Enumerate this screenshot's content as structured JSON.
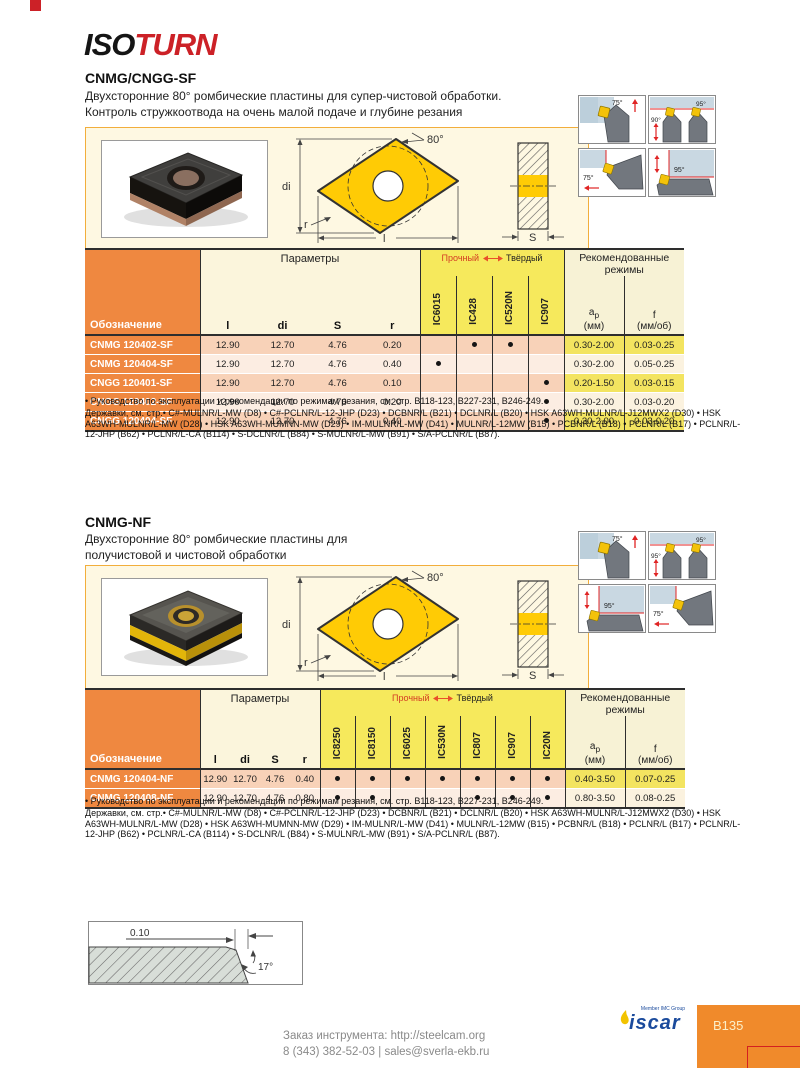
{
  "logo": {
    "part1": "ISO",
    "part2": "TURN"
  },
  "colors": {
    "accent_orange": "#EF8840",
    "grade_yellow": "#F6E95C",
    "row_pink": "#F8D2B8",
    "highlight_yellow": "#F3E460",
    "brand_red": "#CC2127",
    "iscar_blue": "#1A4A9C",
    "panel_cream": "#FEF8E2"
  },
  "sections": [
    {
      "title": "CNMG/CNGG-SF",
      "desc": [
        "Двухсторонние 80° ромбические пластины для супер-чистовой обработки.",
        "Контроль стружкоотвода на очень малой подаче и глубине резания"
      ],
      "tool_icons": [
        {
          "type": 0,
          "angles": [
            "75°"
          ]
        },
        {
          "type": 1,
          "angles": [
            "95°",
            "90°"
          ]
        },
        {
          "type": 2,
          "angles": [
            "75°"
          ]
        },
        {
          "type": 3,
          "angles": [
            "95°"
          ]
        }
      ],
      "drawing": {
        "angle": "80°",
        "d_label": "di",
        "l_label": "l",
        "r_label": "r",
        "s_label": "S"
      },
      "table": {
        "designation": "Обозначение",
        "params_header": "Параметры",
        "param_cols": [
          "l",
          "di",
          "S",
          "r"
        ],
        "tough": "Прочный",
        "hard": "Твёрдый",
        "grades": [
          "IC6015",
          "IC428",
          "IC520N",
          "IC907"
        ],
        "rec_header": "Рекомендованные режимы",
        "rec_cols": [
          {
            "base": "a",
            "sub": "p",
            "unit": "(мм)"
          },
          {
            "base": "f",
            "sub": "",
            "unit": "(мм/об)"
          }
        ],
        "rows": [
          {
            "name": "CNMG 120402-SF",
            "params": [
              "12.90",
              "12.70",
              "4.76",
              "0.20"
            ],
            "dots": [
              0,
              1,
              1,
              0
            ],
            "rec": [
              "0.30-2.00",
              "0.03-0.25"
            ]
          },
          {
            "name": "CNMG 120404-SF",
            "params": [
              "12.90",
              "12.70",
              "4.76",
              "0.40"
            ],
            "dots": [
              1,
              0,
              0,
              0
            ],
            "rec": [
              "0.30-2.00",
              "0.05-0.25"
            ]
          },
          {
            "name": "CNGG 120401-SF",
            "params": [
              "12.90",
              "12.70",
              "4.76",
              "0.10"
            ],
            "dots": [
              0,
              0,
              0,
              1
            ],
            "rec": [
              "0.20-1.50",
              "0.03-0.15"
            ]
          },
          {
            "name": "CNGG 120402-SF",
            "params": [
              "12.90",
              "12.70",
              "4.76",
              "0.20"
            ],
            "dots": [
              0,
              0,
              0,
              1
            ],
            "rec": [
              "0.30-2.00",
              "0.03-0.20"
            ]
          },
          {
            "name": "CNGG 120404-SF",
            "params": [
              "12.90",
              "12.70",
              "4.76",
              "0.40"
            ],
            "dots": [
              0,
              0,
              0,
              1
            ],
            "rec": [
              "0.30-2.00",
              "0.03-0.20"
            ]
          }
        ]
      },
      "notes": {
        "line1": "• Руководство по эксплуатации и рекомендации по режимам резания, см. стр. B118-123, B227-231, B246-249.",
        "line2": "Державки, см. стр.• C#-MULNR/L-MW (D8) • C#-PCLNR/L-12-JHP (D23) • DCBNR/L (B21) • DCLNR/L (B20) • HSK A63WH-MULNR/L-J12MWX2 (D30) • HSK A63WH-MULNR/L-MW (D28) • HSK A63WH-MUMNN-MW (D29) • IM-MULNR/L-MW (D41) • MULNR/L-12MW (B15) • PCBNR/L (B18) • PCLNR/L (B17) • PCLNR/L-12-JHP (B62) • PCLNR/L-CA (B114) • S-DCLNR/L (B84) • S-MULNR/L-MW (B91) • S/A-PCLNR/L (B87)."
      }
    },
    {
      "title": "CNMG-NF",
      "desc": [
        "Двухсторонние 80° ромбические пластины для",
        "получистовой и чистовой обработки"
      ],
      "tool_icons": [
        {
          "type": 0,
          "angles": [
            "75°"
          ]
        },
        {
          "type": 1,
          "angles": [
            "95°",
            "95°"
          ]
        },
        {
          "type": 3,
          "angles": [
            "95°"
          ]
        },
        {
          "type": 2,
          "angles": [
            "75°"
          ]
        }
      ],
      "drawing": {
        "angle": "80°",
        "d_label": "di",
        "l_label": "l",
        "r_label": "r",
        "s_label": "S"
      },
      "table": {
        "designation": "Обозначение",
        "params_header": "Параметры",
        "param_cols": [
          "l",
          "di",
          "S",
          "r"
        ],
        "tough": "Прочный",
        "hard": "Твёрдый",
        "grades": [
          "IC8250",
          "IC8150",
          "IC6025",
          "IC530N",
          "IC807",
          "IC907",
          "IC20N"
        ],
        "rec_header": "Рекомендованные режимы",
        "rec_cols": [
          {
            "base": "a",
            "sub": "p",
            "unit": "(мм)"
          },
          {
            "base": "f",
            "sub": "",
            "unit": "(мм/об)"
          }
        ],
        "rows": [
          {
            "name": "CNMG 120404-NF",
            "params": [
              "12.90",
              "12.70",
              "4.76",
              "0.40"
            ],
            "dots": [
              1,
              1,
              1,
              1,
              1,
              1,
              1
            ],
            "rec": [
              "0.40-3.50",
              "0.07-0.25"
            ]
          },
          {
            "name": "CNMG 120408-NF",
            "params": [
              "12.90",
              "12.70",
              "4.76",
              "0.80"
            ],
            "dots": [
              1,
              1,
              0,
              0,
              1,
              1,
              1
            ],
            "rec": [
              "0.80-3.50",
              "0.08-0.25"
            ]
          }
        ]
      },
      "notes": {
        "line1": "• Руководство по эксплуатации и рекомендации по режимам резания, см. стр. B118-123, B227-231, B246-249.",
        "line2": "Державки, см. стр.• C#-MULNR/L-MW (D8) • C#-PCLNR/L-12-JHP (D23) • DCBNR/L (B21) • DCLNR/L (B20) • HSK A63WH-MULNR/L-J12MWX2 (D30) • HSK A63WH-MULNR/L-MW (D28) • HSK A63WH-MUMNN-MW (D29) • IM-MULNR/L-MW (D41) • MULNR/L-12MW (B15) • PCBNR/L (B18) • PCLNR/L (B17) • PCLNR/L-12-JHP (B62) • PCLNR/L-CA (B114) • S-DCLNR/L (B84) • S-MULNR/L-MW (B91) • S/A-PCLNR/L (B87)."
      }
    }
  ],
  "edge_drawing": {
    "dim": "0.10",
    "angle": "17°"
  },
  "footer": {
    "brand_sub": "Member IMC Group",
    "brand": "iscar",
    "page_badge": "B135",
    "order_line1": "Заказ инструмента: http://steelcam.org",
    "order_line2": "8 (343) 382-52-03  |  sales@sverla-ekb.ru"
  }
}
